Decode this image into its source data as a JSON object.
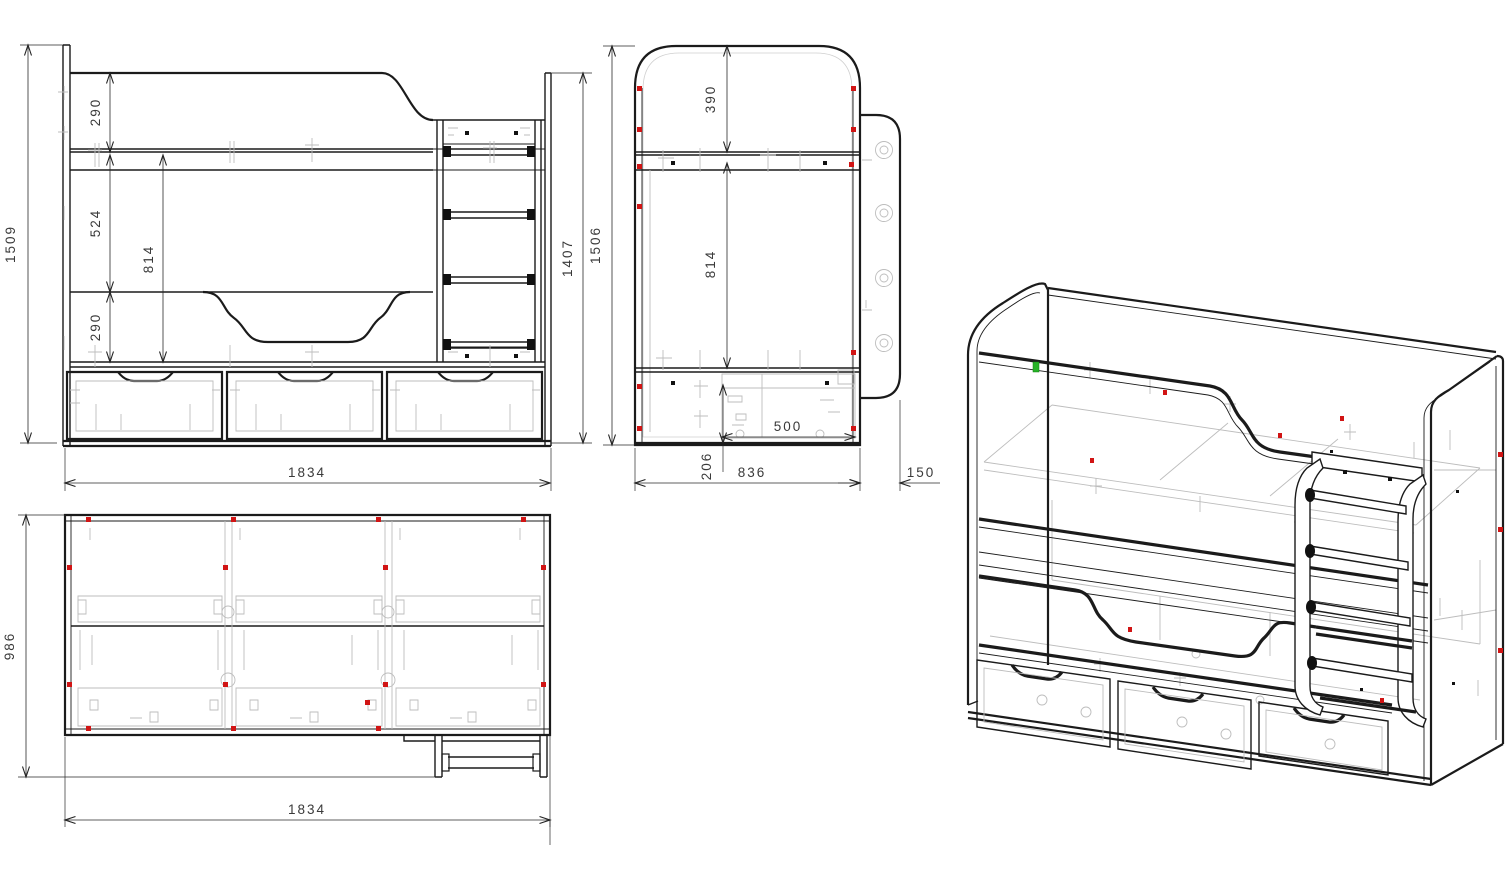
{
  "drawing": {
    "type": "furniture technical drawing - bunk bed with drawers and ladder",
    "views": {
      "front": {
        "name": "front view",
        "dims": {
          "total_height": "1509",
          "top_rail": "290",
          "upper_gap": "524",
          "bunk_gap": "814",
          "lower_rail": "290",
          "width": "1834",
          "side_panel_height": "1407"
        }
      },
      "side": {
        "name": "side view",
        "dims": {
          "total_height": "1506",
          "headboard_top": "390",
          "bunk_gap": "814",
          "drawer_depth": "500",
          "drawer_front_height": "206",
          "bed_depth": "836",
          "ladder_panel_offset": "150"
        }
      },
      "top": {
        "name": "top view",
        "dims": {
          "total_depth": "986",
          "width": "1834"
        }
      },
      "iso": {
        "name": "isometric view"
      }
    },
    "colors": {
      "line": "#1b1b1b",
      "hardware_gray": "#bdbdbd",
      "screw_marker_red": "#d11414",
      "selected_marker_green": "#27b327",
      "dim_text": "#3a3a3a",
      "background": "#ffffff"
    }
  }
}
